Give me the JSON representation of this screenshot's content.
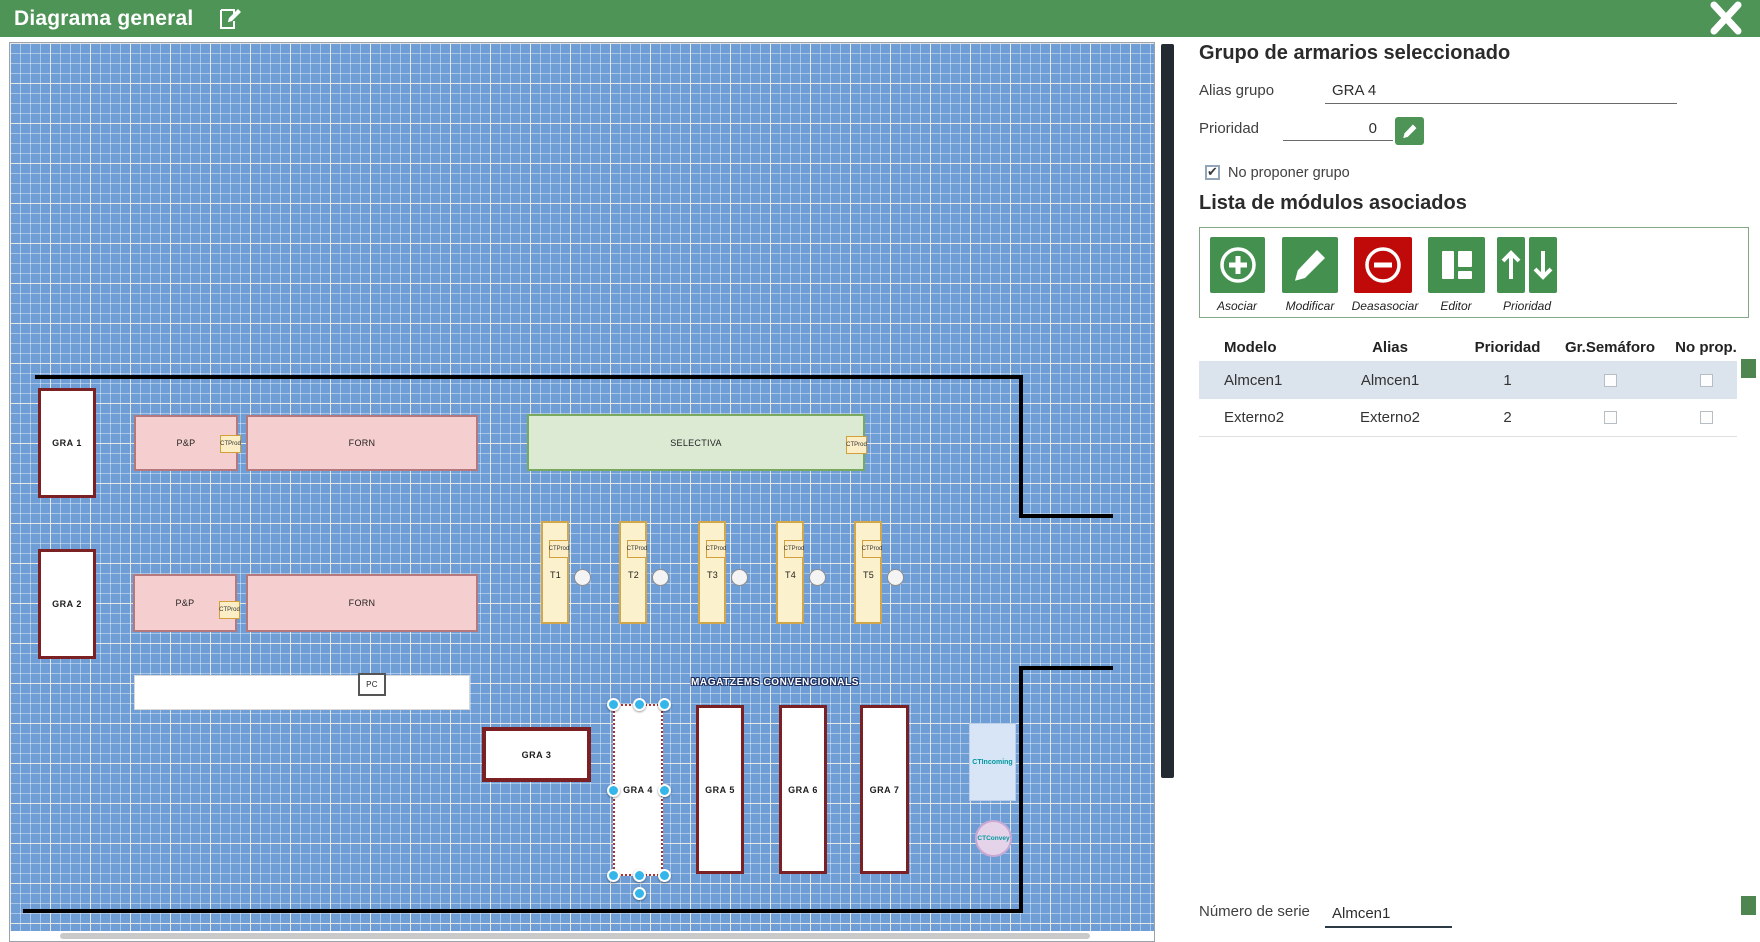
{
  "header": {
    "title": "Diagrama general",
    "edit_icon": "edit-pencil",
    "close_icon": "close-x"
  },
  "panel": {
    "title": "Grupo de armarios seleccionado",
    "alias_label": "Alias grupo",
    "alias_value": "GRA 4",
    "priority_label": "Prioridad",
    "priority_value": "0",
    "priority_edit_icon": "pencil-icon",
    "no_propose_label": "No proponer grupo",
    "no_propose_checked": true,
    "modules_title": "Lista de módulos asociados",
    "toolbar": [
      {
        "label": "Asociar",
        "icon": "plus-circle-icon",
        "color": "#44914f"
      },
      {
        "label": "Modificar",
        "icon": "pencil-icon",
        "color": "#44914f"
      },
      {
        "label": "Deasasociar",
        "icon": "minus-circle-icon",
        "color": "#c00a0a"
      },
      {
        "label": "Editor",
        "icon": "layout-icon",
        "color": "#44914f"
      },
      {
        "label": "Prioridad",
        "icon": "arrow-up-down-icons",
        "color": "#44914f"
      }
    ],
    "table": {
      "columns": [
        "Modelo",
        "Alias",
        "Prioridad",
        "Gr.Semáforo",
        "No prop."
      ],
      "rows": [
        {
          "modelo": "Almcen1",
          "alias": "Almcen1",
          "prioridad": "1",
          "gr_semaforo": false,
          "no_prop": false,
          "selected": true
        },
        {
          "modelo": "Externo2",
          "alias": "Externo2",
          "prioridad": "2",
          "gr_semaforo": false,
          "no_prop": false,
          "selected": false
        }
      ]
    },
    "serial_label": "Número de serie",
    "serial_value": "Almcen1",
    "colors": {
      "accent_green": "#4e9457",
      "action_red": "#c00a0a",
      "selected_row": "#dbe3ec",
      "handle_blue": "#35b6ea"
    }
  },
  "canvas": {
    "gra1": "GRA 1",
    "gra2": "GRA 2",
    "gra3": "GRA 3",
    "gra4": "GRA 4",
    "gra5": "GRA 5",
    "gra6": "GRA 6",
    "gra7": "GRA 7",
    "pp": "P&P",
    "forn": "FORN",
    "selectiva": "SELECTIVA",
    "ctprod": "CTProd",
    "pc": "PC",
    "magatzems": "MAGATZEMS CONVENCIONALS",
    "t1": "T1",
    "t2": "T2",
    "t3": "T3",
    "t4": "T4",
    "t5": "T5",
    "ctincoming": "CTIncoming",
    "ctconvey": "CTConvey"
  }
}
